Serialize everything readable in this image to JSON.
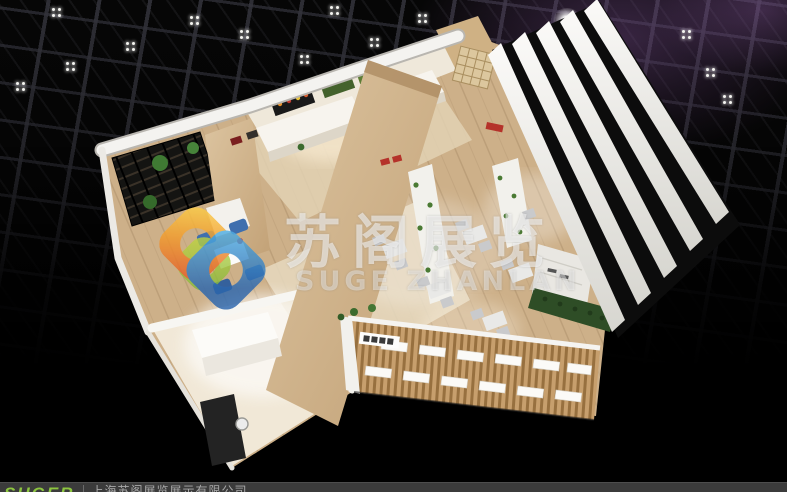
{
  "watermark": {
    "title": "苏阁展览",
    "subtitle": "SUGE ZHANLAN"
  },
  "footer": {
    "logo_text": "SUGER",
    "company_name": "上海苏阁展览展示有限公司"
  },
  "colors": {
    "hall_background": "#050505",
    "truss_gray": "#34343c",
    "purple_glow": "#704884",
    "wood_floor": "#cdb089",
    "wood_slat": "#b98f5c",
    "wall_white": "#f4f3f0",
    "fin_white": "#f5f4f1",
    "accent_red": "#b5322a",
    "plant_green": "#3c6b2e",
    "hedge_green": "#2e4d26",
    "chair_blue": "#3f6fae",
    "logo_green": "#8dc63f",
    "footer_bar": "#3b3b3b",
    "watermark_text": "rgba(255,255,255,0.55)",
    "logo_orange": "#f29b2d",
    "logo_blue": "#2c66ad"
  },
  "scene": {
    "type_label": "3d-exhibition-booth-render",
    "view_label": "aerial-isometric"
  }
}
